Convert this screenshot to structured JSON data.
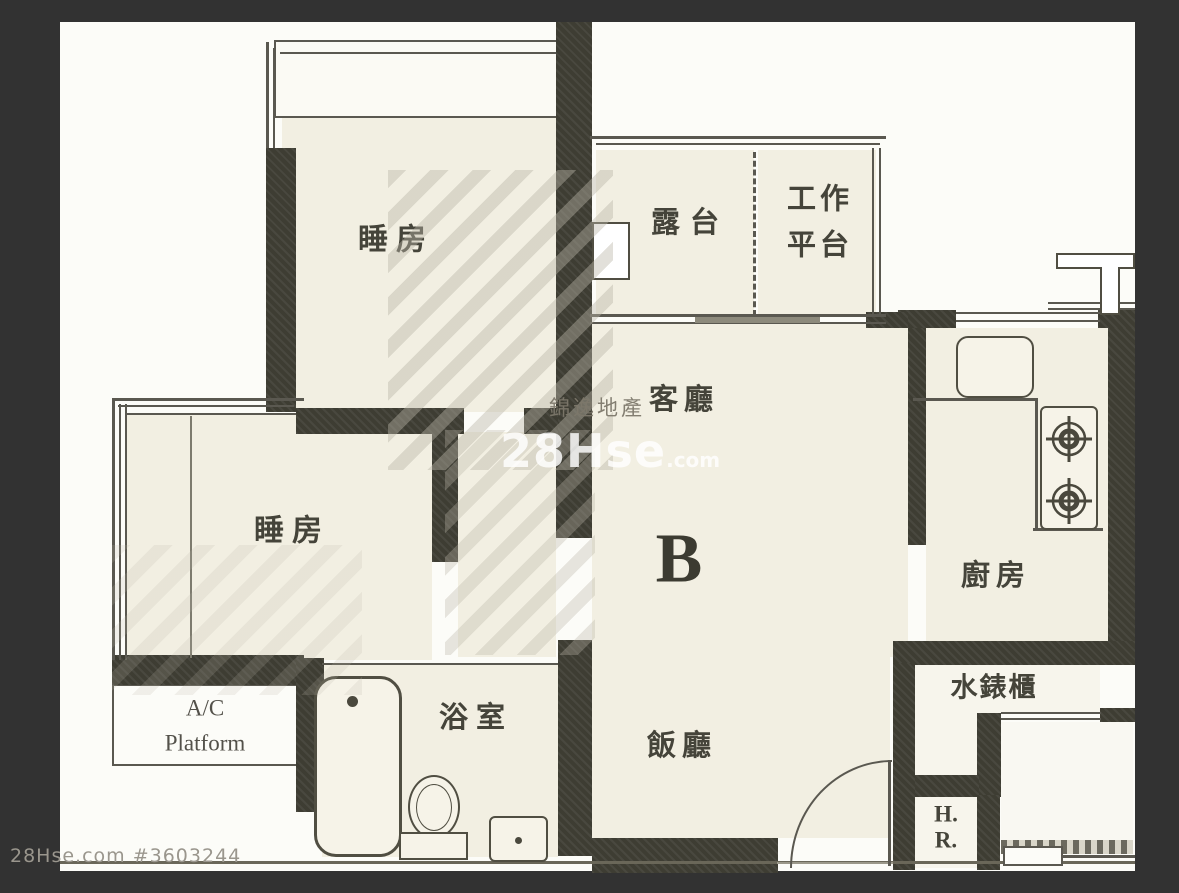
{
  "unit": {
    "label": "B"
  },
  "rooms": {
    "bedroom1": {
      "label": "睡房"
    },
    "bedroom2": {
      "label": "睡房"
    },
    "balcony": {
      "label": "露台"
    },
    "utility": {
      "label": "工作\n平台"
    },
    "living": {
      "label": "客廳"
    },
    "dining": {
      "label": "飯廳"
    },
    "kitchen": {
      "label": "廚房"
    },
    "bathroom": {
      "label": "浴室"
    },
    "meter_cabinet": {
      "label": "水錶櫃"
    },
    "hose_reel": {
      "label": "H.\nR."
    },
    "ac_platform": {
      "label": "A/C\nPlatform"
    }
  },
  "watermarks": {
    "agency": "錦逸地產",
    "brand": "28Hse",
    "brand_suffix": ".com",
    "footer": "28Hse.com #3603244"
  },
  "fixtures": [
    "bathtub",
    "toilet",
    "wash-basin",
    "kitchen-sink",
    "stove-2-burner",
    "entrance-door",
    "ac-unit",
    "flue-duct",
    "water-meter-step"
  ],
  "colors": {
    "frame": "#323232",
    "paper": "#fcfcf8",
    "room_fill": "#f2efe2",
    "wall": "#3e3d33",
    "line": "#5a5850",
    "label": "#45443a",
    "watermark_white": "rgba(255,255,255,0.82)",
    "watermark_gray": "#9a968d"
  }
}
